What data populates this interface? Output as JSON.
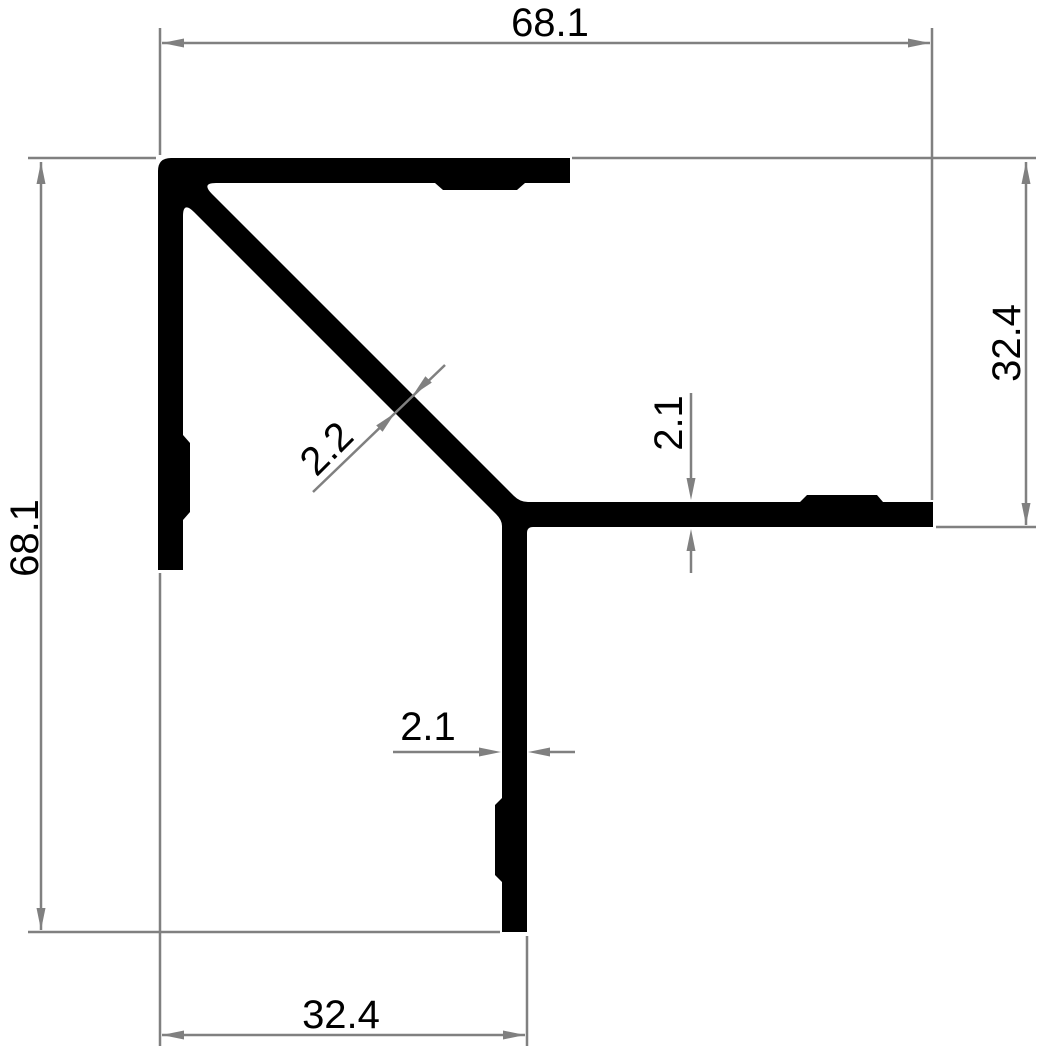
{
  "drawing": {
    "title": "Corner profile cross-section technical drawing",
    "colors": {
      "background": "#ffffff",
      "profile_fill": "#000000",
      "dimension_lines": "#808080",
      "dimension_text": "#000000"
    },
    "labels": {
      "overall_width": "68.1",
      "overall_height": "68.1",
      "right_leg_length": "32.4",
      "bottom_leg_length": "32.4",
      "right_wall_thickness": "2.1",
      "bottom_wall_thickness": "2.1",
      "diagonal_wall_thickness": "2.2"
    }
  }
}
